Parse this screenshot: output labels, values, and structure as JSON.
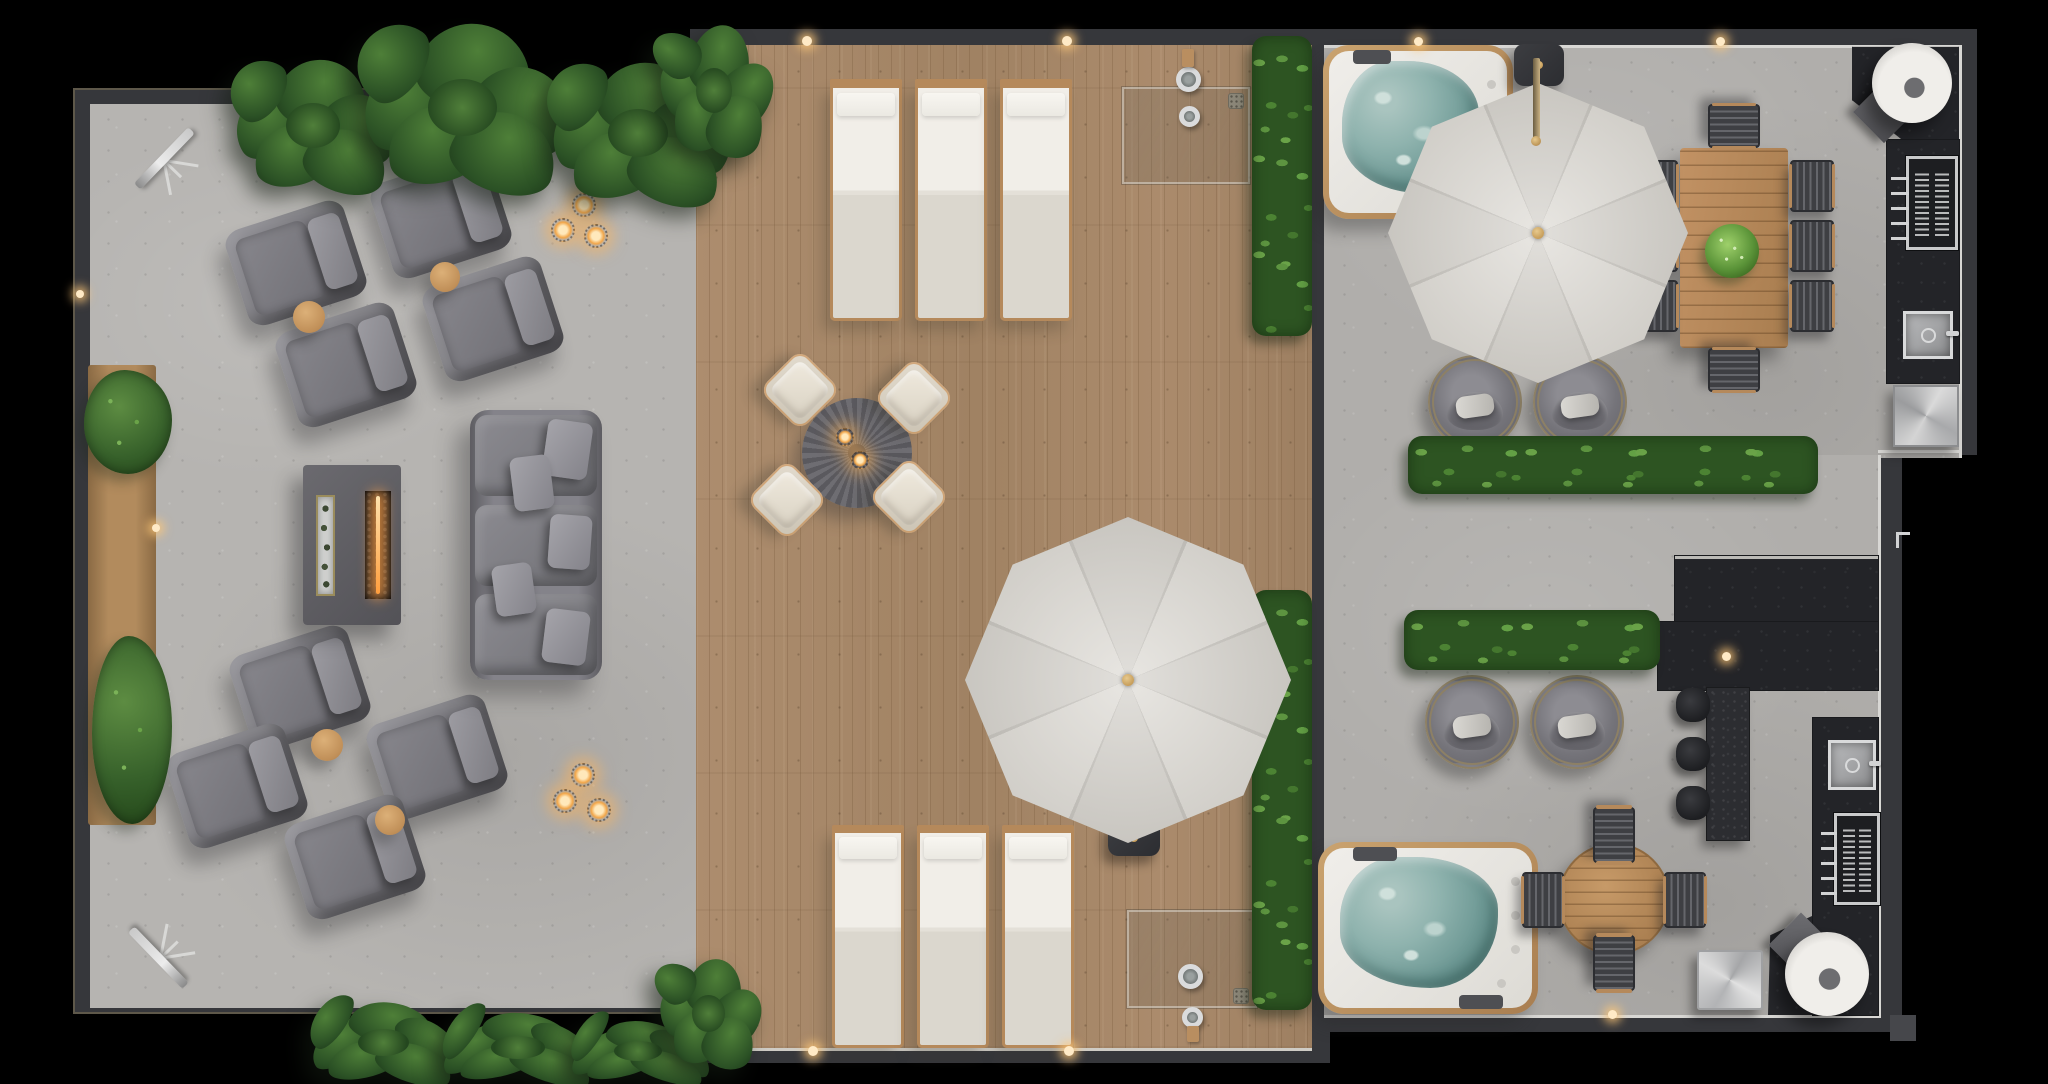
{
  "meta": {
    "title": "rooftop-terrace-floor-plan",
    "view": "top-down architectural render",
    "visible_text": "none"
  },
  "palette": {
    "background": "#000000",
    "wall": "#36373b",
    "concrete_floor": "#b6b4b1",
    "concrete_floor_right": "#b0aeab",
    "deck_wood": "#a8886a",
    "hedge_green": "#4c8333",
    "palm_green": "#2b5125",
    "hot_tub_water": "#8fb3ae",
    "umbrella_canvas": "#d8d5cf",
    "upholstery_gray": "#77767c",
    "teak_wood": "#b5895b",
    "kitchen_counter": "#232428",
    "stainless": "#c9cacb",
    "flame_accent": "#ff9e3d"
  },
  "zones": [
    {
      "name": "lounge-zone",
      "floor": "concrete",
      "features": [
        "8 armchairs",
        "4 round side tables",
        "fire-pit table",
        "3-seat sectional sofa",
        "planter bench",
        "2 telescopes",
        "2 candle clusters"
      ]
    },
    {
      "name": "deck-zone",
      "floor": "wood planks",
      "features": [
        "6 sun loungers",
        "round dining table with 4 chairs",
        "2 cantilever umbrellas",
        "2 outdoor showers",
        "vertical hedges"
      ]
    },
    {
      "name": "spa-dining-zone",
      "floor": "concrete",
      "features": [
        "2 hot tubs",
        "8-seat teak dining table",
        "4 swivel lounge chairs",
        "outdoor kitchen with grills and sinks",
        "bar with 3 stools",
        "2 pizza ovens",
        "hedge rows"
      ]
    }
  ],
  "objects": [
    {
      "n": "telescope",
      "t": "telescope",
      "x": 118,
      "y": 112,
      "w": 92,
      "h": 92,
      "r": -46
    },
    {
      "n": "telescope",
      "t": "telescope",
      "x": 112,
      "y": 912,
      "w": 92,
      "h": 92,
      "r": -134
    },
    {
      "n": "planter-bench",
      "t": "planter",
      "x": 88,
      "y": 365,
      "w": 68,
      "h": 460
    },
    {
      "n": "planter-bush",
      "t": "bush",
      "x": 84,
      "y": 370,
      "w": 88,
      "h": 104
    },
    {
      "n": "planter-bush",
      "t": "bush",
      "x": 92,
      "y": 636,
      "w": 80,
      "h": 188
    },
    {
      "n": "armchair",
      "t": "armchair",
      "x": 234,
      "y": 213,
      "w": 124,
      "h": 100,
      "r": -18
    },
    {
      "n": "armchair",
      "t": "armchair",
      "x": 379,
      "y": 166,
      "w": 124,
      "h": 100,
      "r": -18
    },
    {
      "n": "armchair",
      "t": "armchair",
      "x": 284,
      "y": 315,
      "w": 124,
      "h": 100,
      "r": -18
    },
    {
      "n": "armchair",
      "t": "armchair",
      "x": 431,
      "y": 269,
      "w": 124,
      "h": 100,
      "r": -18
    },
    {
      "n": "side-table",
      "t": "sidetable",
      "x": 293,
      "y": 301,
      "w": 32,
      "h": 32
    },
    {
      "n": "side-table",
      "t": "sidetable",
      "x": 430,
      "y": 262,
      "w": 30,
      "h": 30
    },
    {
      "n": "armchair",
      "t": "armchair",
      "x": 238,
      "y": 638,
      "w": 124,
      "h": 100,
      "r": -18
    },
    {
      "n": "armchair",
      "t": "armchair",
      "x": 375,
      "y": 707,
      "w": 124,
      "h": 100,
      "r": -18
    },
    {
      "n": "armchair",
      "t": "armchair",
      "x": 175,
      "y": 736,
      "w": 124,
      "h": 100,
      "r": -18
    },
    {
      "n": "armchair",
      "t": "armchair",
      "x": 293,
      "y": 807,
      "w": 124,
      "h": 100,
      "r": -18
    },
    {
      "n": "side-table",
      "t": "sidetable",
      "x": 311,
      "y": 729,
      "w": 32,
      "h": 32
    },
    {
      "n": "side-table",
      "t": "sidetable",
      "x": 375,
      "y": 805,
      "w": 30,
      "h": 30
    },
    {
      "n": "fire-pit-table",
      "t": "firetable",
      "x": 303,
      "y": 465,
      "w": 98,
      "h": 160
    },
    {
      "n": "sectional-sofa",
      "t": "sofa",
      "x": 470,
      "y": 410,
      "w": 132,
      "h": 270
    },
    {
      "n": "candle-lantern",
      "t": "candle",
      "x": 572,
      "y": 193,
      "w": 24,
      "h": 24
    },
    {
      "n": "candle-lantern",
      "t": "candle",
      "x": 551,
      "y": 218,
      "w": 24,
      "h": 24
    },
    {
      "n": "candle-lantern",
      "t": "candle",
      "x": 584,
      "y": 224,
      "w": 24,
      "h": 24
    },
    {
      "n": "candle-lantern",
      "t": "candle",
      "x": 571,
      "y": 763,
      "w": 24,
      "h": 24
    },
    {
      "n": "candle-lantern",
      "t": "candle",
      "x": 553,
      "y": 789,
      "w": 24,
      "h": 24
    },
    {
      "n": "candle-lantern",
      "t": "candle",
      "x": 587,
      "y": 798,
      "w": 24,
      "h": 24
    },
    {
      "n": "sun-lounger",
      "t": "lounger",
      "x": 830,
      "y": 83,
      "w": 72,
      "h": 238
    },
    {
      "n": "sun-lounger",
      "t": "lounger",
      "x": 915,
      "y": 83,
      "w": 72,
      "h": 238
    },
    {
      "n": "sun-lounger",
      "t": "lounger",
      "x": 1000,
      "y": 83,
      "w": 72,
      "h": 238
    },
    {
      "n": "sun-lounger",
      "t": "lounger",
      "x": 832,
      "y": 828,
      "w": 72,
      "h": 220
    },
    {
      "n": "sun-lounger",
      "t": "lounger",
      "x": 917,
      "y": 828,
      "w": 72,
      "h": 220
    },
    {
      "n": "sun-lounger",
      "t": "lounger",
      "x": 1002,
      "y": 828,
      "w": 72,
      "h": 220
    },
    {
      "n": "deck-round-table",
      "t": "decktable",
      "x": 802,
      "y": 398,
      "w": 110,
      "h": 110
    },
    {
      "n": "table-candle",
      "t": "candle",
      "x": 836,
      "y": 428,
      "w": 18,
      "h": 18
    },
    {
      "n": "table-candle",
      "t": "candle",
      "x": 851,
      "y": 451,
      "w": 18,
      "h": 18
    },
    {
      "n": "deck-chair",
      "t": "deckchair",
      "x": 885,
      "y": 369,
      "w": 58,
      "h": 58,
      "r": 45
    },
    {
      "n": "deck-chair",
      "t": "deckchair",
      "x": 771,
      "y": 361,
      "w": 58,
      "h": 58,
      "r": 45
    },
    {
      "n": "deck-chair",
      "t": "deckchair",
      "x": 758,
      "y": 471,
      "w": 58,
      "h": 58,
      "r": 45
    },
    {
      "n": "deck-chair",
      "t": "deckchair",
      "x": 880,
      "y": 468,
      "w": 58,
      "h": 58,
      "r": 45
    },
    {
      "n": "shower-glass-panel",
      "t": "glass",
      "x": 1122,
      "y": 87,
      "w": 128,
      "h": 97
    },
    {
      "n": "shower-head",
      "t": "cring",
      "x": 1176,
      "y": 67,
      "w": 25,
      "h": 25
    },
    {
      "n": "shower-valve",
      "t": "cring",
      "x": 1179,
      "y": 106,
      "w": 21,
      "h": 21
    },
    {
      "n": "shower-wood-mount",
      "t": "woodtab",
      "x": 1182,
      "y": 49,
      "w": 12,
      "h": 18
    },
    {
      "n": "shower-drain",
      "t": "drain",
      "x": 1228,
      "y": 93,
      "w": 16,
      "h": 16
    },
    {
      "n": "shower-glass-panel",
      "t": "glass",
      "x": 1127,
      "y": 910,
      "w": 130,
      "h": 98
    },
    {
      "n": "shower-head",
      "t": "cring",
      "x": 1178,
      "y": 964,
      "w": 25,
      "h": 25
    },
    {
      "n": "shower-valve",
      "t": "cring",
      "x": 1182,
      "y": 1007,
      "w": 21,
      "h": 21
    },
    {
      "n": "shower-wood-mount",
      "t": "woodtab",
      "x": 1187,
      "y": 1026,
      "w": 12,
      "h": 16
    },
    {
      "n": "shower-drain",
      "t": "drain",
      "x": 1233,
      "y": 988,
      "w": 16,
      "h": 16
    },
    {
      "n": "hedge-vertical",
      "t": "hedge v",
      "x": 1252,
      "y": 36,
      "w": 60,
      "h": 300
    },
    {
      "n": "hedge-vertical",
      "t": "hedge v",
      "x": 1252,
      "y": 590,
      "w": 60,
      "h": 420
    },
    {
      "n": "hot-tub",
      "t": "hottub",
      "x": 1323,
      "y": 45,
      "w": 190,
      "h": 174
    },
    {
      "n": "hot-tub",
      "t": "hottub",
      "x": 1318,
      "y": 842,
      "w": 220,
      "h": 172
    },
    {
      "n": "cantilever-umbrella",
      "t": "umbrella",
      "x": 1388,
      "y": 83,
      "w": 300,
      "h": 300
    },
    {
      "n": "umbrella-arm",
      "t": "uarm",
      "x": 1533,
      "y": 58,
      "w": 7,
      "h": 80
    },
    {
      "n": "umbrella-mount",
      "t": "ubase",
      "x": 1514,
      "y": 44,
      "w": 50,
      "h": 42
    },
    {
      "n": "deck-umbrella",
      "t": "umbrella",
      "x": 965,
      "y": 517,
      "w": 326,
      "h": 326
    },
    {
      "n": "umbrella-base",
      "t": "ubase",
      "x": 1108,
      "y": 820,
      "w": 52,
      "h": 36
    },
    {
      "n": "swivel-chair",
      "t": "swivel",
      "x": 1428,
      "y": 355,
      "w": 94,
      "h": 94
    },
    {
      "n": "swivel-chair",
      "t": "swivel",
      "x": 1533,
      "y": 355,
      "w": 94,
      "h": 94
    },
    {
      "n": "swivel-chair",
      "t": "swivel",
      "x": 1425,
      "y": 675,
      "w": 94,
      "h": 94
    },
    {
      "n": "swivel-chair",
      "t": "swivel",
      "x": 1530,
      "y": 675,
      "w": 94,
      "h": 94
    },
    {
      "n": "hedge-row",
      "t": "hedge",
      "x": 1408,
      "y": 436,
      "w": 410,
      "h": 58
    },
    {
      "n": "hedge-row",
      "t": "hedge",
      "x": 1404,
      "y": 610,
      "w": 256,
      "h": 60
    },
    {
      "n": "dining-table",
      "t": "wtable",
      "x": 1680,
      "y": 148,
      "w": 108,
      "h": 200
    },
    {
      "n": "table-plant",
      "t": "plantball",
      "x": 1705,
      "y": 224,
      "w": 54,
      "h": 54
    },
    {
      "n": "dining-chair",
      "t": "dchair",
      "x": 1790,
      "y": 160,
      "w": 44,
      "h": 52
    },
    {
      "n": "dining-chair",
      "t": "dchair",
      "x": 1790,
      "y": 220,
      "w": 44,
      "h": 52
    },
    {
      "n": "dining-chair",
      "t": "dchair",
      "x": 1790,
      "y": 280,
      "w": 44,
      "h": 52
    },
    {
      "n": "dining-chair",
      "t": "dchair",
      "x": 1634,
      "y": 160,
      "w": 44,
      "h": 52
    },
    {
      "n": "dining-chair",
      "t": "dchair",
      "x": 1634,
      "y": 220,
      "w": 44,
      "h": 52
    },
    {
      "n": "dining-chair",
      "t": "dchair",
      "x": 1634,
      "y": 280,
      "w": 44,
      "h": 52
    },
    {
      "n": "dining-chair",
      "t": "dchair",
      "x": 1712,
      "y": 100,
      "w": 44,
      "h": 52,
      "r": 90
    },
    {
      "n": "dining-chair",
      "t": "dchair",
      "x": 1712,
      "y": 344,
      "w": 44,
      "h": 52,
      "r": 90
    },
    {
      "n": "corner-counter",
      "t": "counter",
      "x": 1852,
      "y": 45,
      "w": 107,
      "h": 95,
      "clip": "polygon(0% 2%,100% 2%,100% 100%,47% 100%,0% 58%)"
    },
    {
      "n": "pizza-oven",
      "t": "oven",
      "x": 1872,
      "y": 43,
      "w": 80,
      "h": 80
    },
    {
      "n": "serving-tray",
      "t": "tray",
      "x": 1862,
      "y": 90,
      "w": 44,
      "h": 44,
      "r": 45
    },
    {
      "n": "kitchen-counter",
      "t": "counter",
      "x": 1887,
      "y": 140,
      "w": 72,
      "h": 243
    },
    {
      "n": "grill",
      "t": "grill",
      "x": 1906,
      "y": 156,
      "w": 52,
      "h": 94
    },
    {
      "n": "kitchen-sink",
      "t": "sink",
      "x": 1903,
      "y": 311,
      "w": 50,
      "h": 48
    },
    {
      "n": "outdoor-fridge",
      "t": "fridge",
      "x": 1893,
      "y": 385,
      "w": 66,
      "h": 62
    },
    {
      "n": "bar-back-wall",
      "t": "counter lip",
      "x": 1675,
      "y": 556,
      "w": 203,
      "h": 70
    },
    {
      "n": "bar-front",
      "t": "counter",
      "x": 1658,
      "y": 622,
      "w": 220,
      "h": 68
    },
    {
      "n": "bar-counter",
      "t": "barcol",
      "x": 1707,
      "y": 688,
      "w": 42,
      "h": 152
    },
    {
      "n": "bar-stool",
      "t": "stool",
      "x": 1676,
      "y": 688,
      "w": 34,
      "h": 34
    },
    {
      "n": "bar-stool",
      "t": "stool",
      "x": 1676,
      "y": 737,
      "w": 34,
      "h": 34
    },
    {
      "n": "bar-stool",
      "t": "stool",
      "x": 1676,
      "y": 786,
      "w": 34,
      "h": 34
    },
    {
      "n": "kitchen-counter",
      "t": "counter",
      "x": 1813,
      "y": 718,
      "w": 65,
      "h": 297
    },
    {
      "n": "kitchen-sink",
      "t": "sink",
      "x": 1828,
      "y": 740,
      "w": 48,
      "h": 50
    },
    {
      "n": "grill",
      "t": "grill",
      "x": 1834,
      "y": 813,
      "w": 46,
      "h": 92
    },
    {
      "n": "kitchen-floor-pad",
      "t": "patch",
      "x": 1768,
      "y": 914,
      "w": 110,
      "h": 101,
      "clip": "polygon(0% 100%,2% 21%,40% 2%,100% 2%,100% 100%)"
    },
    {
      "n": "pizza-oven",
      "t": "oven",
      "x": 1785,
      "y": 932,
      "w": 84,
      "h": 84
    },
    {
      "n": "serving-tray",
      "t": "tray",
      "x": 1778,
      "y": 922,
      "w": 46,
      "h": 46,
      "r": 45
    },
    {
      "n": "stainless-cube-table",
      "t": "cube",
      "x": 1697,
      "y": 950,
      "w": 66,
      "h": 60
    },
    {
      "n": "round-dining-table",
      "t": "rtable",
      "x": 1558,
      "y": 843,
      "w": 112,
      "h": 112
    },
    {
      "n": "dining-chair",
      "t": "dchair",
      "x": 1586,
      "y": 814,
      "w": 56,
      "h": 42,
      "r": 90
    },
    {
      "n": "dining-chair",
      "t": "dchair",
      "x": 1586,
      "y": 942,
      "w": 56,
      "h": 42,
      "r": 90
    },
    {
      "n": "dining-chair",
      "t": "dchair",
      "x": 1522,
      "y": 872,
      "w": 42,
      "h": 56
    },
    {
      "n": "dining-chair",
      "t": "dchair",
      "x": 1664,
      "y": 872,
      "w": 42,
      "h": 56
    },
    {
      "n": "door-handle",
      "t": "handle",
      "x": 1896,
      "y": 532,
      "w": 14,
      "h": 16
    },
    {
      "n": "drain-pipe",
      "t": "stub",
      "x": 1890,
      "y": 1015,
      "w": 26,
      "h": 26
    },
    {
      "n": "tropical-plants",
      "t": "tropical",
      "x": 225,
      "y": 55,
      "w": 180,
      "h": 150
    },
    {
      "n": "tropical-plants",
      "t": "tropical",
      "x": 350,
      "y": 18,
      "w": 230,
      "h": 190
    },
    {
      "n": "tropical-plants",
      "t": "tropical",
      "x": 540,
      "y": 58,
      "w": 200,
      "h": 160
    },
    {
      "n": "tropical-plants",
      "t": "tropical",
      "x": 655,
      "y": 20,
      "w": 120,
      "h": 150
    },
    {
      "n": "tropical-plants",
      "t": "tropical",
      "x": 300,
      "y": 1000,
      "w": 170,
      "h": 90
    },
    {
      "n": "tropical-plants",
      "t": "tropical",
      "x": 430,
      "y": 1012,
      "w": 180,
      "h": 75
    },
    {
      "n": "tropical-plants",
      "t": "tropical",
      "x": 560,
      "y": 1020,
      "w": 160,
      "h": 66
    },
    {
      "n": "tropical-plants",
      "t": "tropical",
      "x": 655,
      "y": 955,
      "w": 110,
      "h": 124
    },
    {
      "n": "wall-light",
      "t": "wlight",
      "x": 802,
      "y": 36,
      "w": 10,
      "h": 10
    },
    {
      "n": "wall-light",
      "t": "wlight",
      "x": 1062,
      "y": 36,
      "w": 10,
      "h": 10
    },
    {
      "n": "wall-light",
      "t": "wlight",
      "x": 1414,
      "y": 37,
      "w": 9,
      "h": 9
    },
    {
      "n": "wall-light",
      "t": "wlight",
      "x": 1716,
      "y": 37,
      "w": 9,
      "h": 9
    },
    {
      "n": "wall-light",
      "t": "wlight",
      "x": 808,
      "y": 1046,
      "w": 10,
      "h": 10
    },
    {
      "n": "wall-light",
      "t": "wlight",
      "x": 1064,
      "y": 1046,
      "w": 10,
      "h": 10
    },
    {
      "n": "wall-light",
      "t": "wlight",
      "x": 1608,
      "y": 1010,
      "w": 9,
      "h": 9
    },
    {
      "n": "wall-light",
      "t": "wlight",
      "x": 76,
      "y": 290,
      "w": 8,
      "h": 8
    },
    {
      "n": "wall-light",
      "t": "wlight",
      "x": 152,
      "y": 524,
      "w": 8,
      "h": 8
    },
    {
      "n": "bar-light",
      "t": "wlight",
      "x": 1722,
      "y": 652,
      "w": 9,
      "h": 9
    },
    {
      "n": "step-edge",
      "t": "eline",
      "x": 1878,
      "y": 450,
      "w": 81,
      "h": 3
    }
  ]
}
